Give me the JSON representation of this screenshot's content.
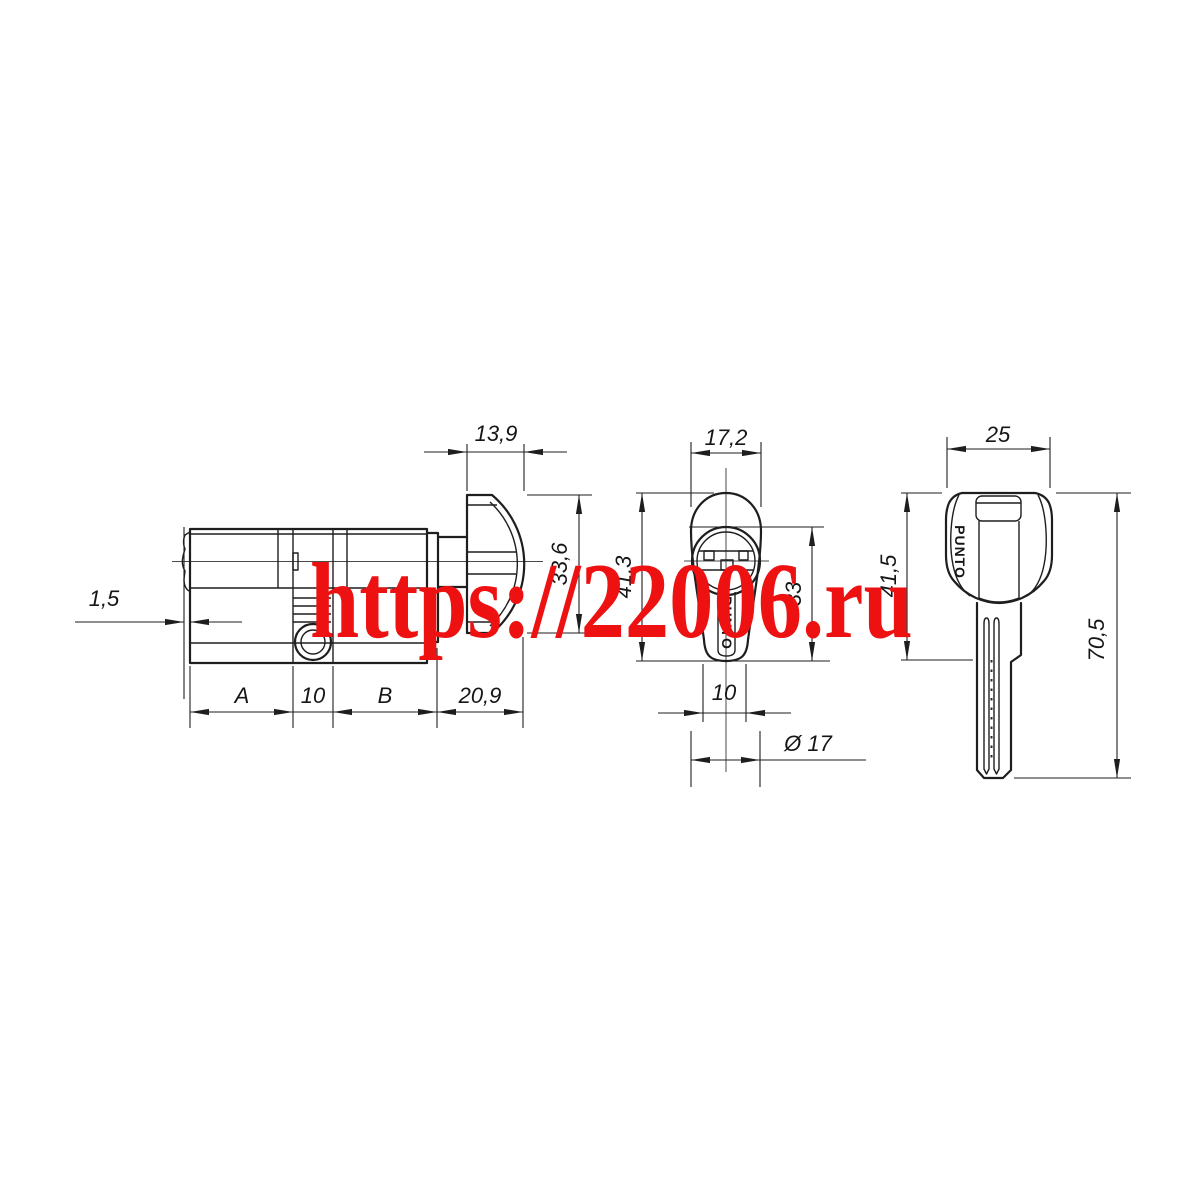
{
  "watermark": {
    "text": "https://22006.ru",
    "color": "#ee1111"
  },
  "side_view": {
    "dim_knob_thickness": "13,9",
    "dim_knob_height": "33,6",
    "dim_tip": "1,5",
    "dim_a": "A",
    "dim_center": "10",
    "dim_b": "B",
    "dim_knob_section": "20,9"
  },
  "front_view": {
    "dim_width": "17,2",
    "dim_height": "41,3",
    "dim_body_height": "33",
    "dim_slot_width": "10",
    "dim_diameter": "Ø 17",
    "brand": "PUNTO"
  },
  "key_view": {
    "dim_bow_width": "25",
    "dim_bow_height": "41,5",
    "dim_total_length": "70,5",
    "brand": "PUNTO"
  }
}
